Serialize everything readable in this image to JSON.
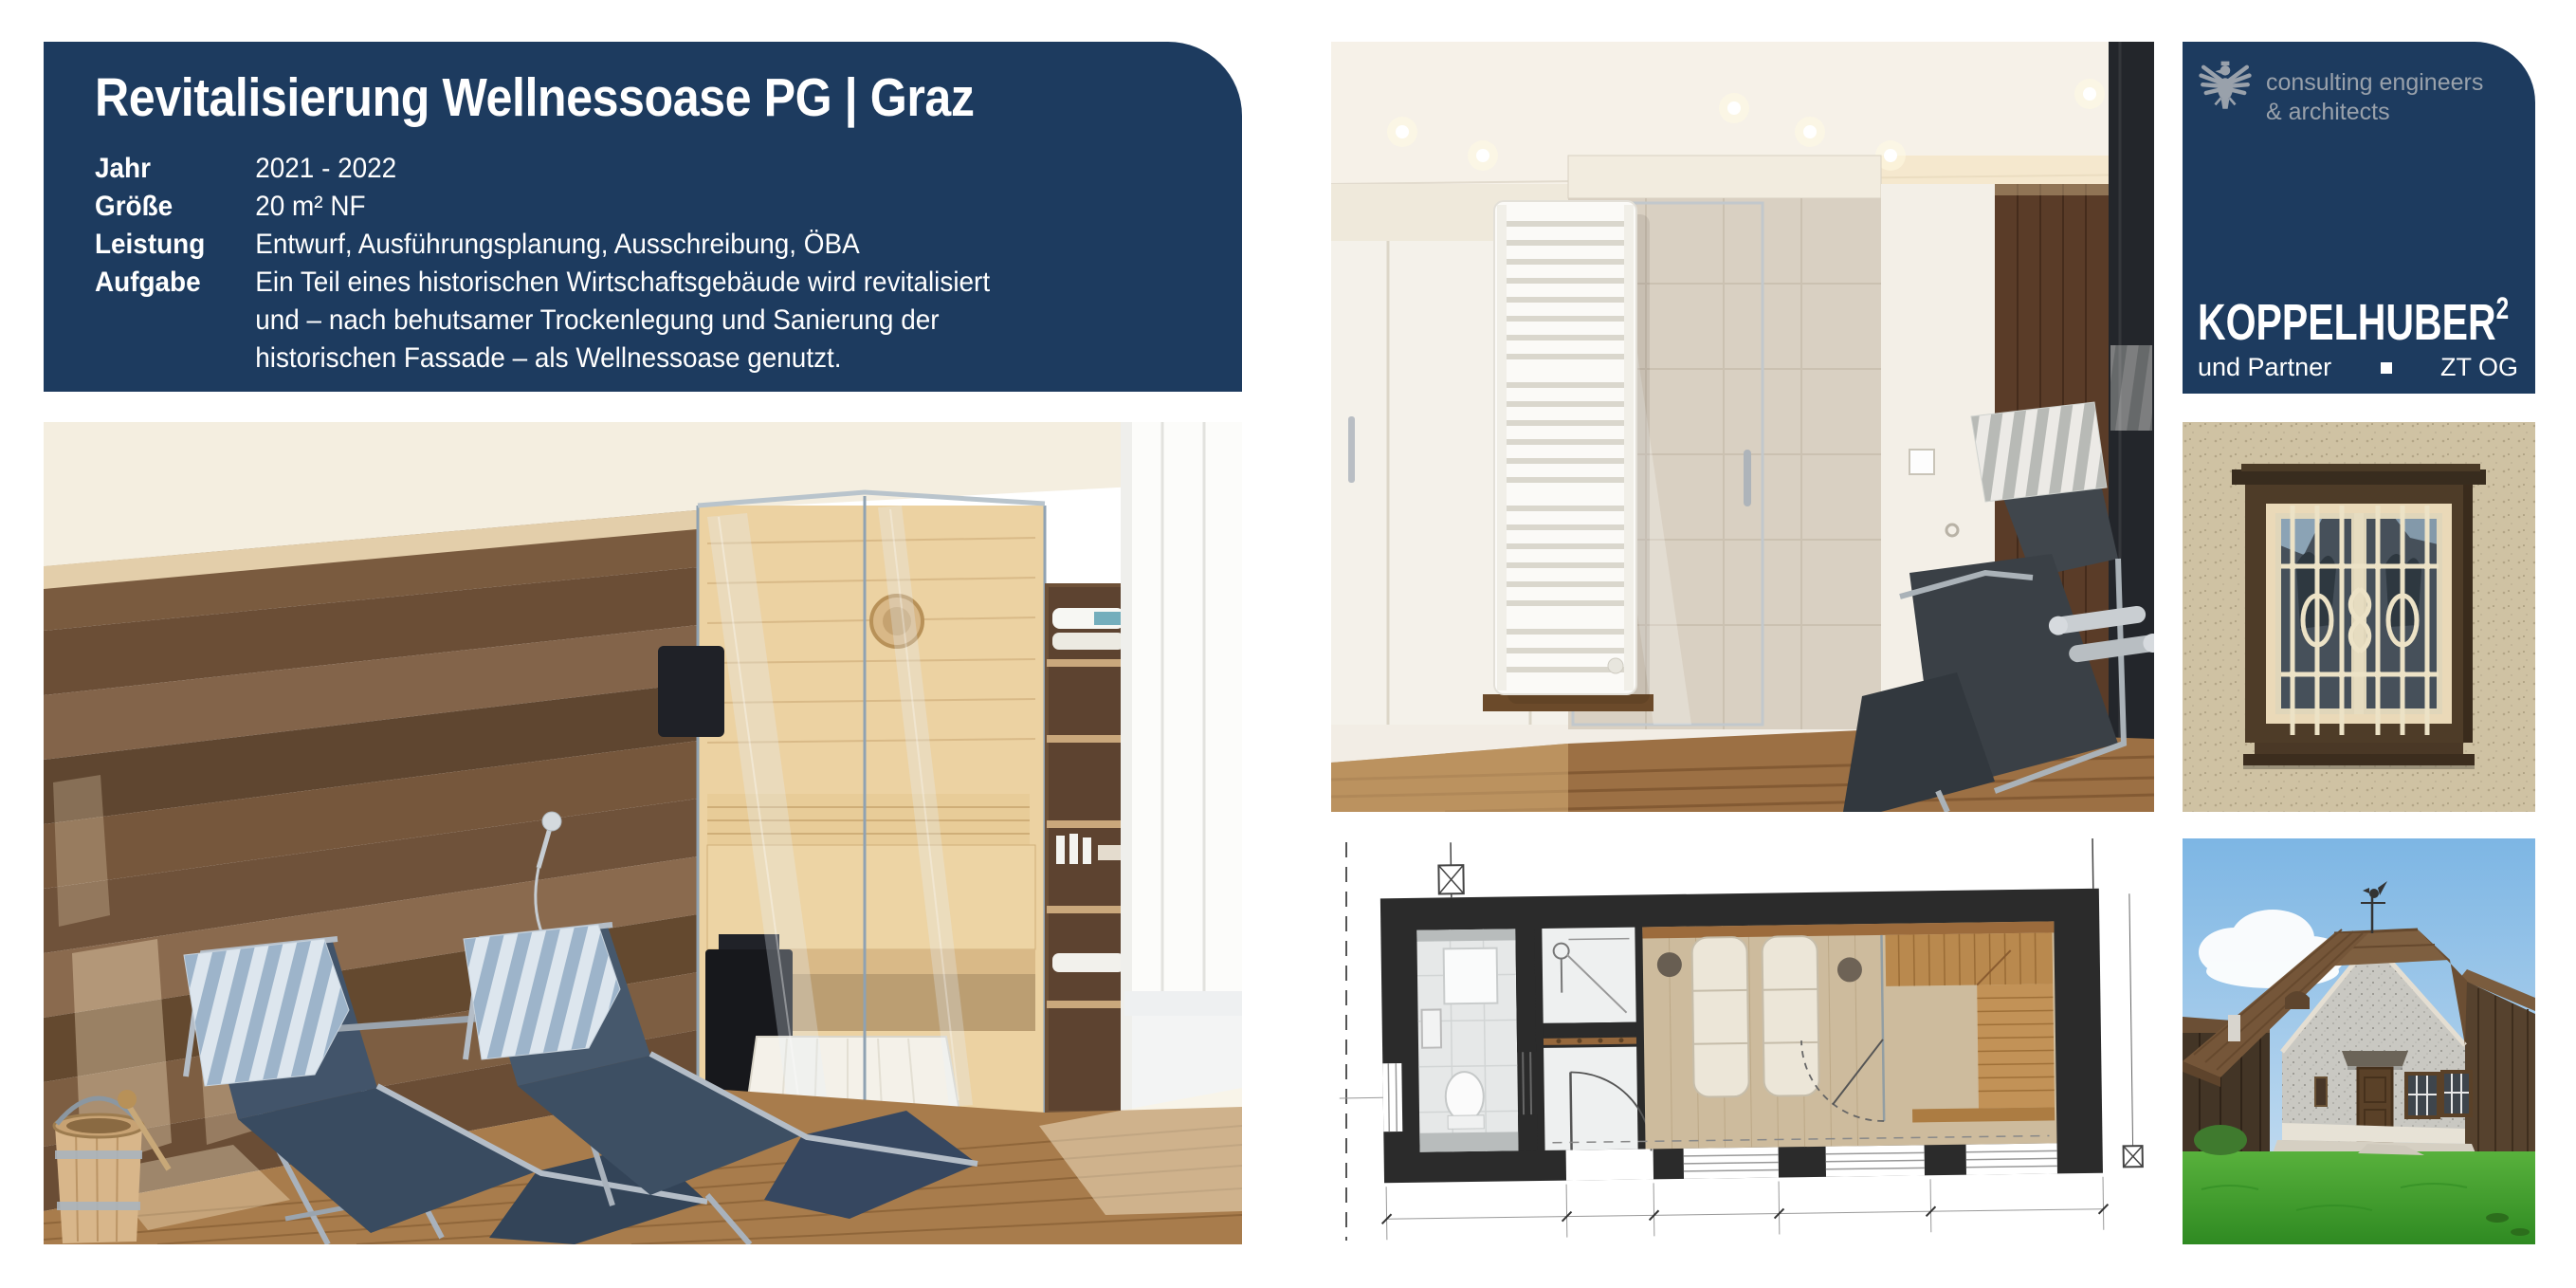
{
  "page": {
    "background": "#ffffff"
  },
  "colors": {
    "navy": "#1d3b5f",
    "logo_gray": "#99a1ab",
    "white": "#ffffff"
  },
  "header": {
    "title": "Revitalisierung Wellnessoase PG | Graz",
    "rows": [
      {
        "label": "Jahr",
        "lines": [
          "2021 - 2022"
        ]
      },
      {
        "label": "Größe",
        "lines": [
          "20 m² NF"
        ]
      },
      {
        "label": "Leistung",
        "lines": [
          "Entwurf, Ausführungsplanung, Ausschreibung, ÖBA"
        ]
      },
      {
        "label": "Aufgabe",
        "lines": [
          "Ein Teil eines historischen Wirtschaftsgebäude wird revitalisiert",
          "und – nach behutsamer Trockenlegung und Sanierung der",
          "historischen Fassade – als Wellnessoase genutzt."
        ]
      }
    ]
  },
  "logo": {
    "tagline_line1": "consulting engineers",
    "tagline_line2": "& architects",
    "name": "KOPPELHUBER",
    "superscript": "2",
    "sub_left": "und Partner",
    "sub_right": "ZT OG",
    "eagle_icon": "austrian-eagle"
  },
  "figures": {
    "sauna_room": {
      "description": "Wellness room with two blue relax loungers with striped towels, glass sauna cabin, wooden plank walls and oak floor"
    },
    "bathroom": {
      "description": "Bathroom with white towel radiator, glass shower, dark wood wall and relax lounger"
    },
    "floor_plan": {
      "description": "Floor plan of the wellness oasis with bathroom, shower, two loungers and sauna bench"
    },
    "window": {
      "description": "Historic facade window with brown frame and ornamental cream security grille"
    },
    "farmhouse": {
      "description": "Historic farm building with hipped shingle roof, weathervane and lawn"
    }
  }
}
